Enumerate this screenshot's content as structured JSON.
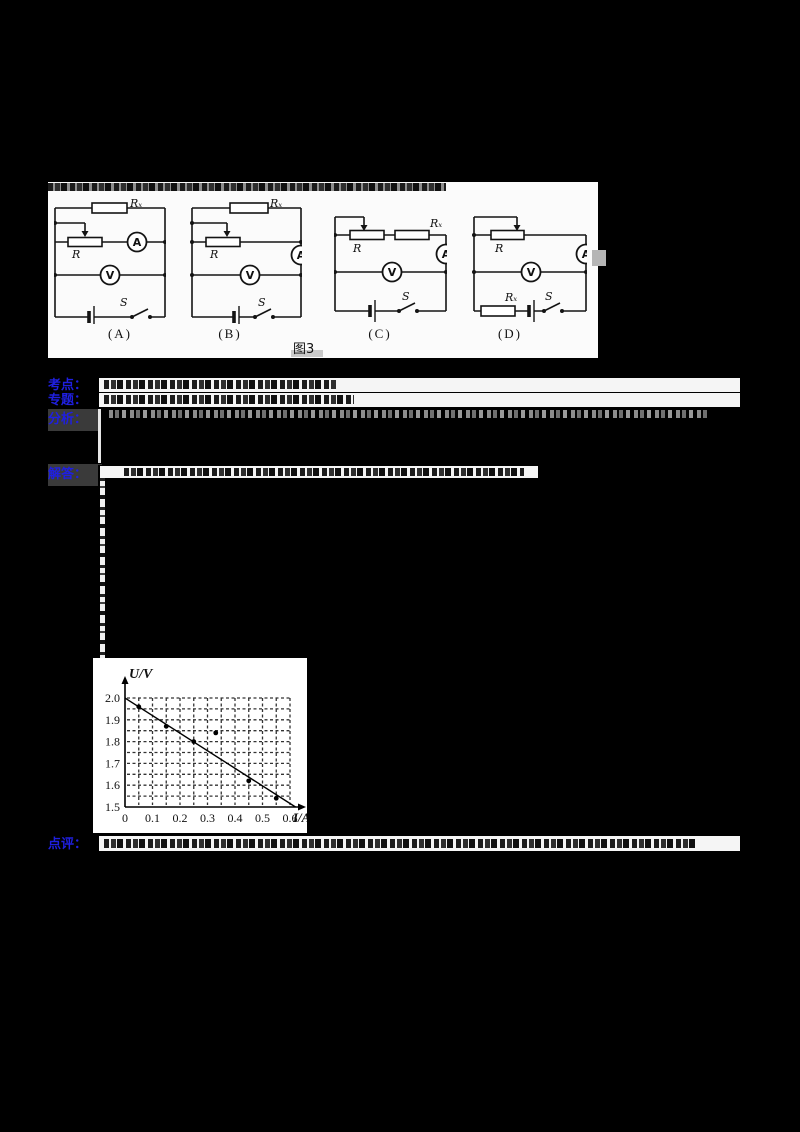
{
  "page": {
    "background": "#000000"
  },
  "figure_panel": {
    "figure_caption": "图3",
    "circuits": [
      {
        "id": "A",
        "caption": "(A)",
        "labels": {
          "rx": "Rₓ",
          "r": "R",
          "ammeter": "A",
          "voltmeter": "V",
          "switch": "S"
        }
      },
      {
        "id": "B",
        "caption": "(B)",
        "labels": {
          "rx": "Rₓ",
          "r": "R",
          "ammeter": "A",
          "voltmeter": "V",
          "switch": "S"
        }
      },
      {
        "id": "C",
        "caption": "(C)",
        "labels": {
          "rx": "Rₓ",
          "r": "R",
          "ammeter": "A",
          "voltmeter": "V",
          "switch": "S"
        }
      },
      {
        "id": "D",
        "caption": "(D)",
        "labels": {
          "rx": "Rₓ",
          "r": "R",
          "ammeter": "A",
          "voltmeter": "V",
          "switch": "S"
        }
      }
    ]
  },
  "sections": [
    {
      "name": "kaodian",
      "label": "考点："
    },
    {
      "name": "zhuanti",
      "label": "专题："
    },
    {
      "name": "fenxi",
      "label": "分析："
    },
    {
      "name": "jieda",
      "label": "解答："
    },
    {
      "name": "dianping",
      "label": "点评："
    }
  ],
  "chart_data": {
    "type": "line",
    "title": "U/V",
    "xlabel": "I/A",
    "ylabel": "U/V",
    "xlim": [
      0,
      0.6
    ],
    "ylim": [
      1.5,
      2.0
    ],
    "x_ticks": [
      "0",
      "0.1",
      "0.2",
      "0.3",
      "0.4",
      "0.5",
      "0.6"
    ],
    "y_ticks": [
      "2.0",
      "1.9",
      "1.8",
      "1.7",
      "1.6",
      "1.5"
    ],
    "grid": "dashed every 0.05 in both axes",
    "legend_position": "none",
    "fit_line": [
      [
        0,
        2.0
      ],
      [
        0.62,
        1.5
      ]
    ],
    "points": [
      [
        0.05,
        1.96
      ],
      [
        0.15,
        1.87
      ],
      [
        0.25,
        1.8
      ],
      [
        0.33,
        1.84
      ],
      [
        0.45,
        1.62
      ],
      [
        0.55,
        1.54
      ]
    ]
  }
}
